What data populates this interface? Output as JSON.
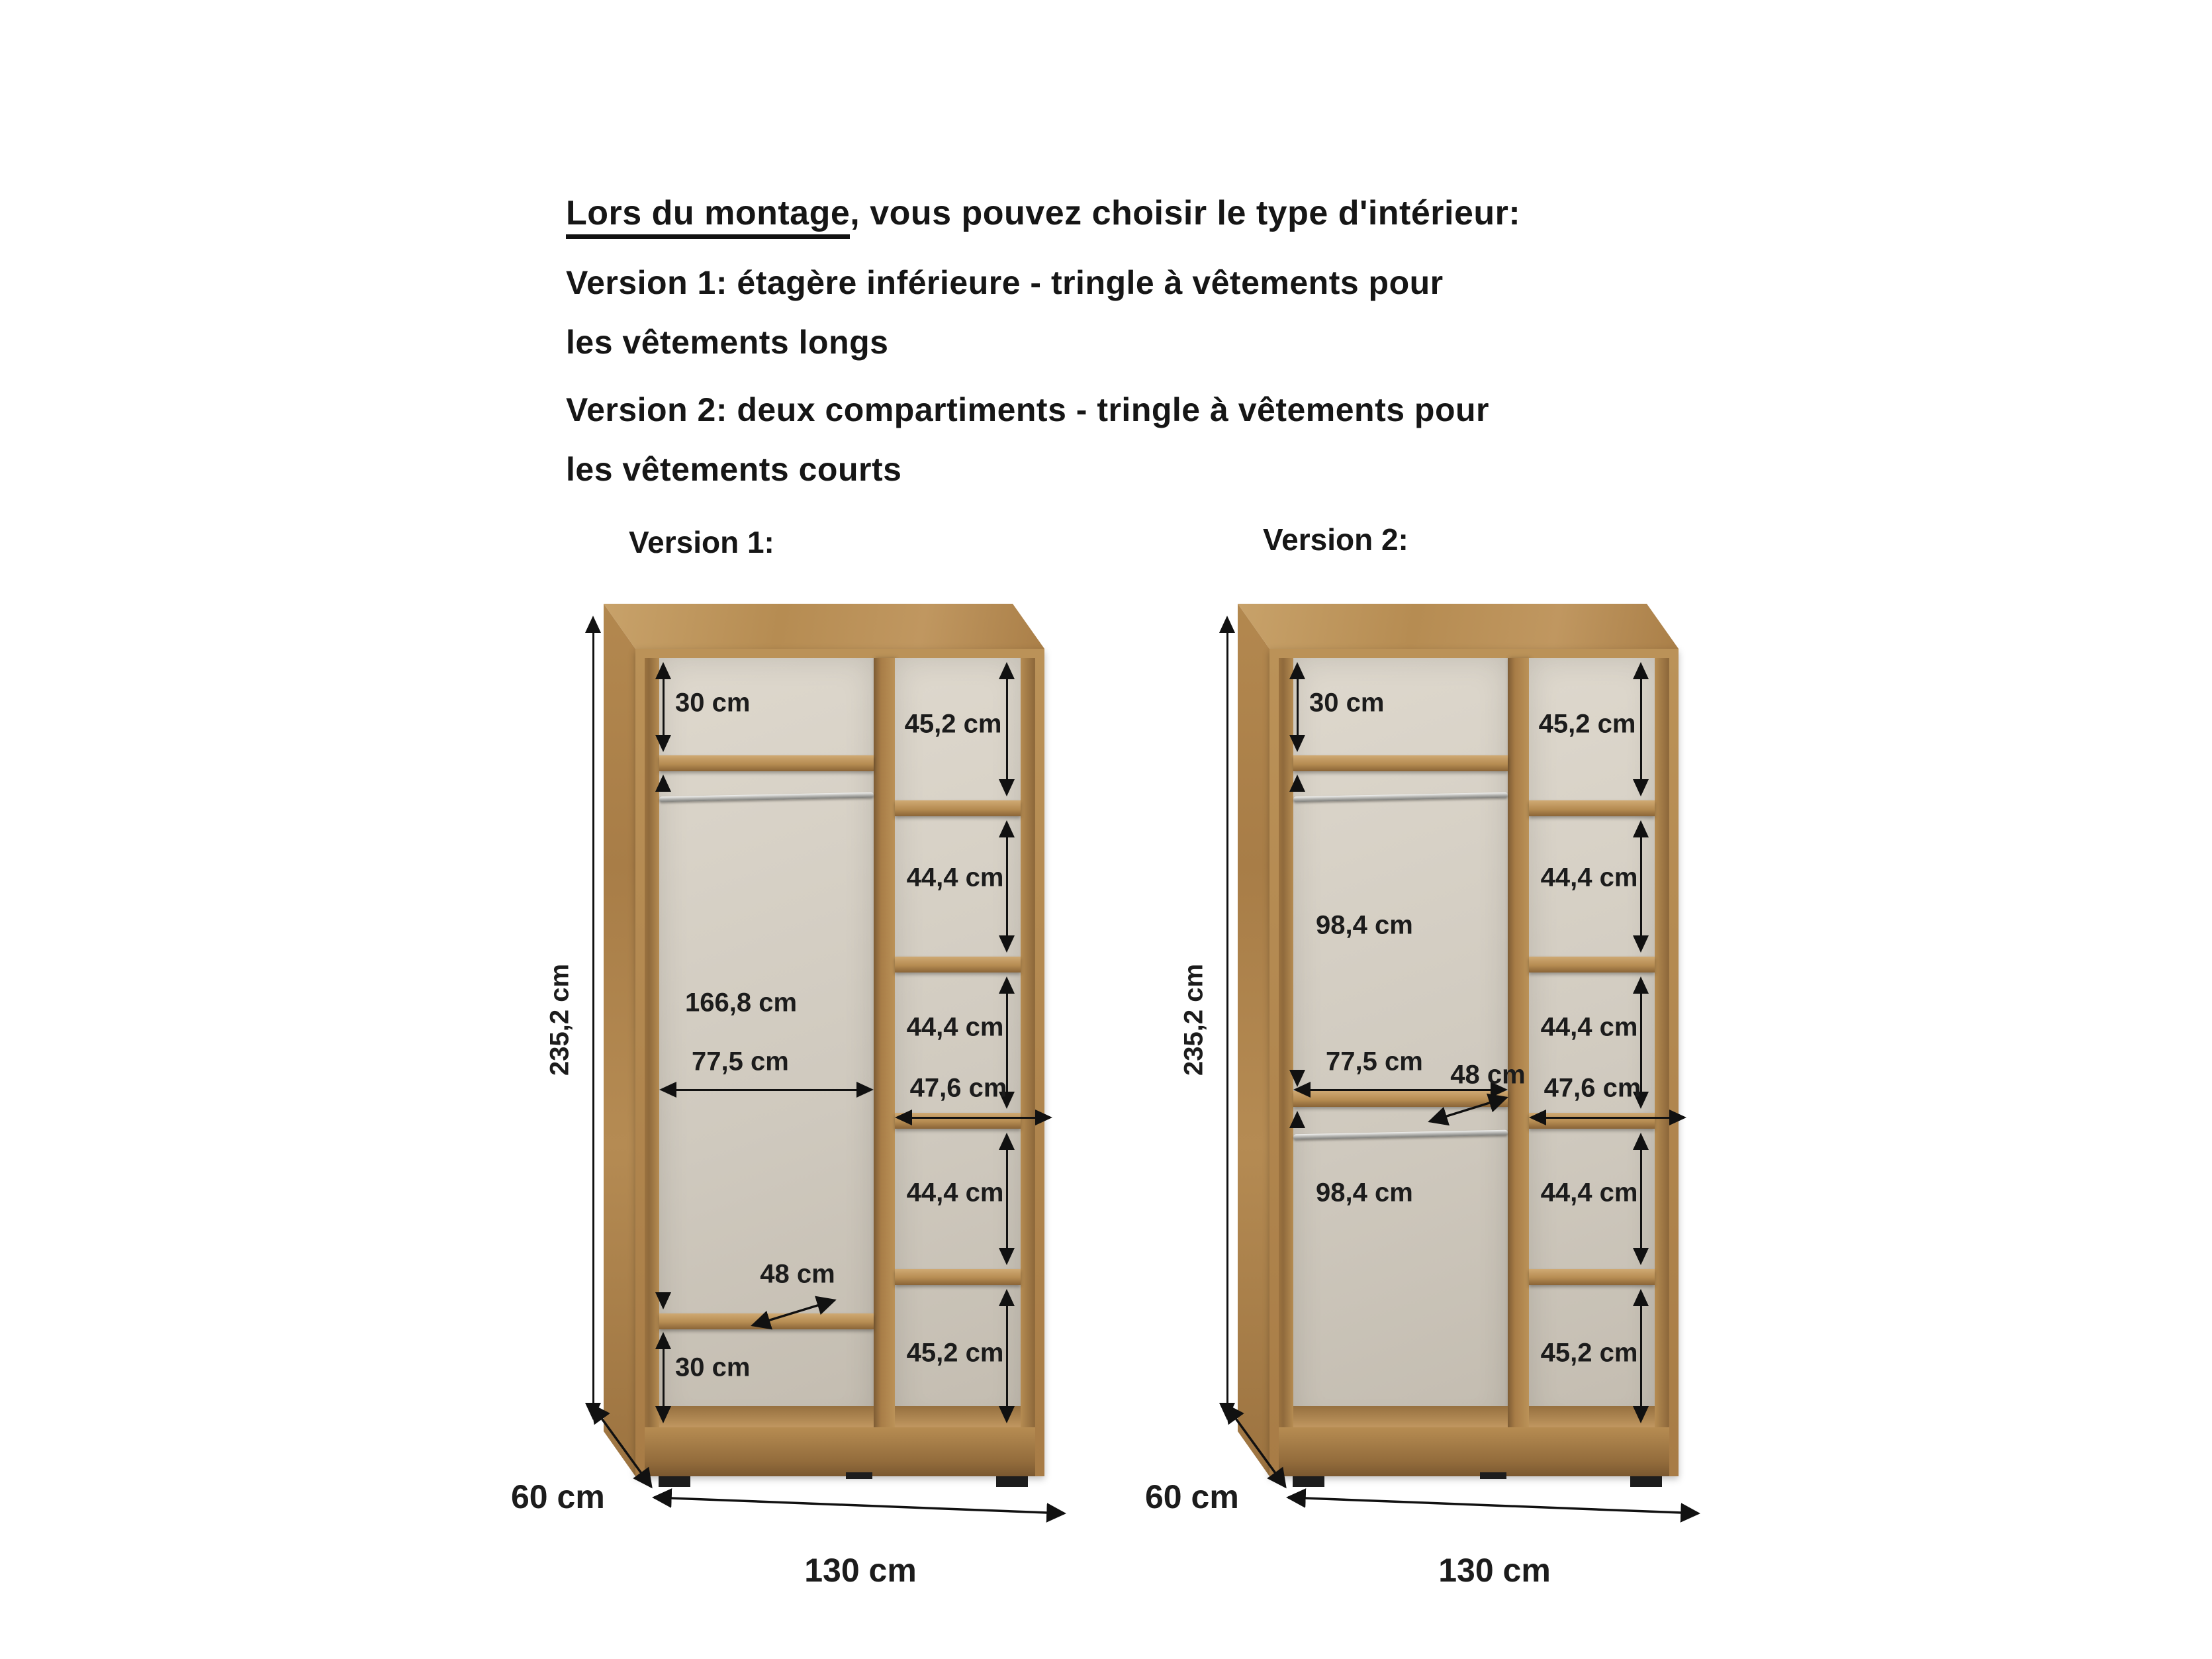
{
  "header": {
    "intro_underlined": "Lors du montage",
    "intro_rest": ", vous pouvez choisir le type d'intérieur:",
    "line2": "Version 1: étagère inférieure - tringle à vêtements pour",
    "line3": "les vêtements longs",
    "line4": "Version 2: deux compartiments - tringle à vêtements pour",
    "line5": "les vêtements courts"
  },
  "version1": {
    "title": "Version 1:",
    "height_label": "235,2 cm",
    "depth_label": "60 cm",
    "width_label": "130 cm",
    "left_column": {
      "top_section": "30 cm",
      "hanging_section": "166,8 cm",
      "inner_width": "77,5 cm",
      "shelf_depth": "48 cm",
      "bottom_section": "30 cm"
    },
    "right_column": {
      "sections": [
        "45,2 cm",
        "44,4 cm",
        "44,4 cm",
        "44,4 cm",
        "45,2 cm"
      ],
      "inner_width": "47,6 cm"
    }
  },
  "version2": {
    "title": "Version 2:",
    "height_label": "235,2 cm",
    "depth_label": "60 cm",
    "width_label": "130 cm",
    "left_column": {
      "top_section": "30 cm",
      "upper_hanging_section": "98,4 cm",
      "inner_width": "77,5 cm",
      "shelf_depth": "48 cm",
      "lower_hanging_section": "98,4 cm"
    },
    "right_column": {
      "sections": [
        "45,2 cm",
        "44,4 cm",
        "44,4 cm",
        "44,4 cm",
        "45,2 cm"
      ],
      "inner_width": "47,6 cm"
    }
  }
}
